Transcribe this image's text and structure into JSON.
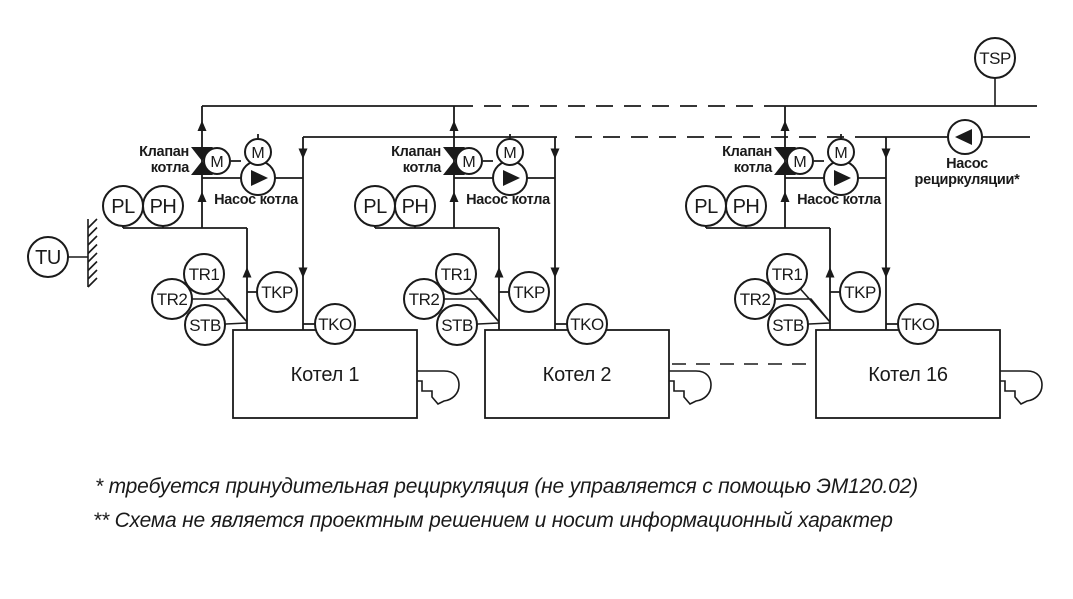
{
  "diagram": {
    "groups": [
      {
        "boiler_label": "Котел 1",
        "valve_label_line1": "Клапан",
        "valve_label_line2": "котла",
        "pump_label": "Насос котла",
        "valve_motor_label": "M",
        "pump_motor_label": "M",
        "sensors": {
          "pl": "PL",
          "ph": "PH",
          "tr1": "TR1",
          "tr2": "TR2",
          "stb": "STB",
          "tkp": "TKP",
          "tko": "TKO"
        }
      },
      {
        "boiler_label": "Котел 2",
        "valve_label_line1": "Клапан",
        "valve_label_line2": "котла",
        "pump_label": "Насос котла",
        "valve_motor_label": "M",
        "pump_motor_label": "M",
        "sensors": {
          "pl": "PL",
          "ph": "PH",
          "tr1": "TR1",
          "tr2": "TR2",
          "stb": "STB",
          "tkp": "TKP",
          "tko": "TKO"
        }
      },
      {
        "boiler_label": "Котел 16",
        "valve_label_line1": "Клапан",
        "valve_label_line2": "котла",
        "pump_label": "Насос котла",
        "valve_motor_label": "M",
        "pump_motor_label": "M",
        "sensors": {
          "pl": "PL",
          "ph": "PH",
          "tr1": "TR1",
          "tr2": "TR2",
          "stb": "STB",
          "tkp": "TKP",
          "tko": "TKO"
        }
      }
    ],
    "outdoor_sensor_label": "TU",
    "supply_sensor_label": "TSP",
    "recirc": {
      "line1": "Насос",
      "line2": "рециркуляции*"
    },
    "footnotes": [
      "* требуется принудительная рециркуляция (не управляется с помощью ЭМ120.02)",
      "** Схема не является проектным решением и носит информационный характер"
    ],
    "line_color": "#1a1a1a",
    "background_color": "#ffffff"
  }
}
